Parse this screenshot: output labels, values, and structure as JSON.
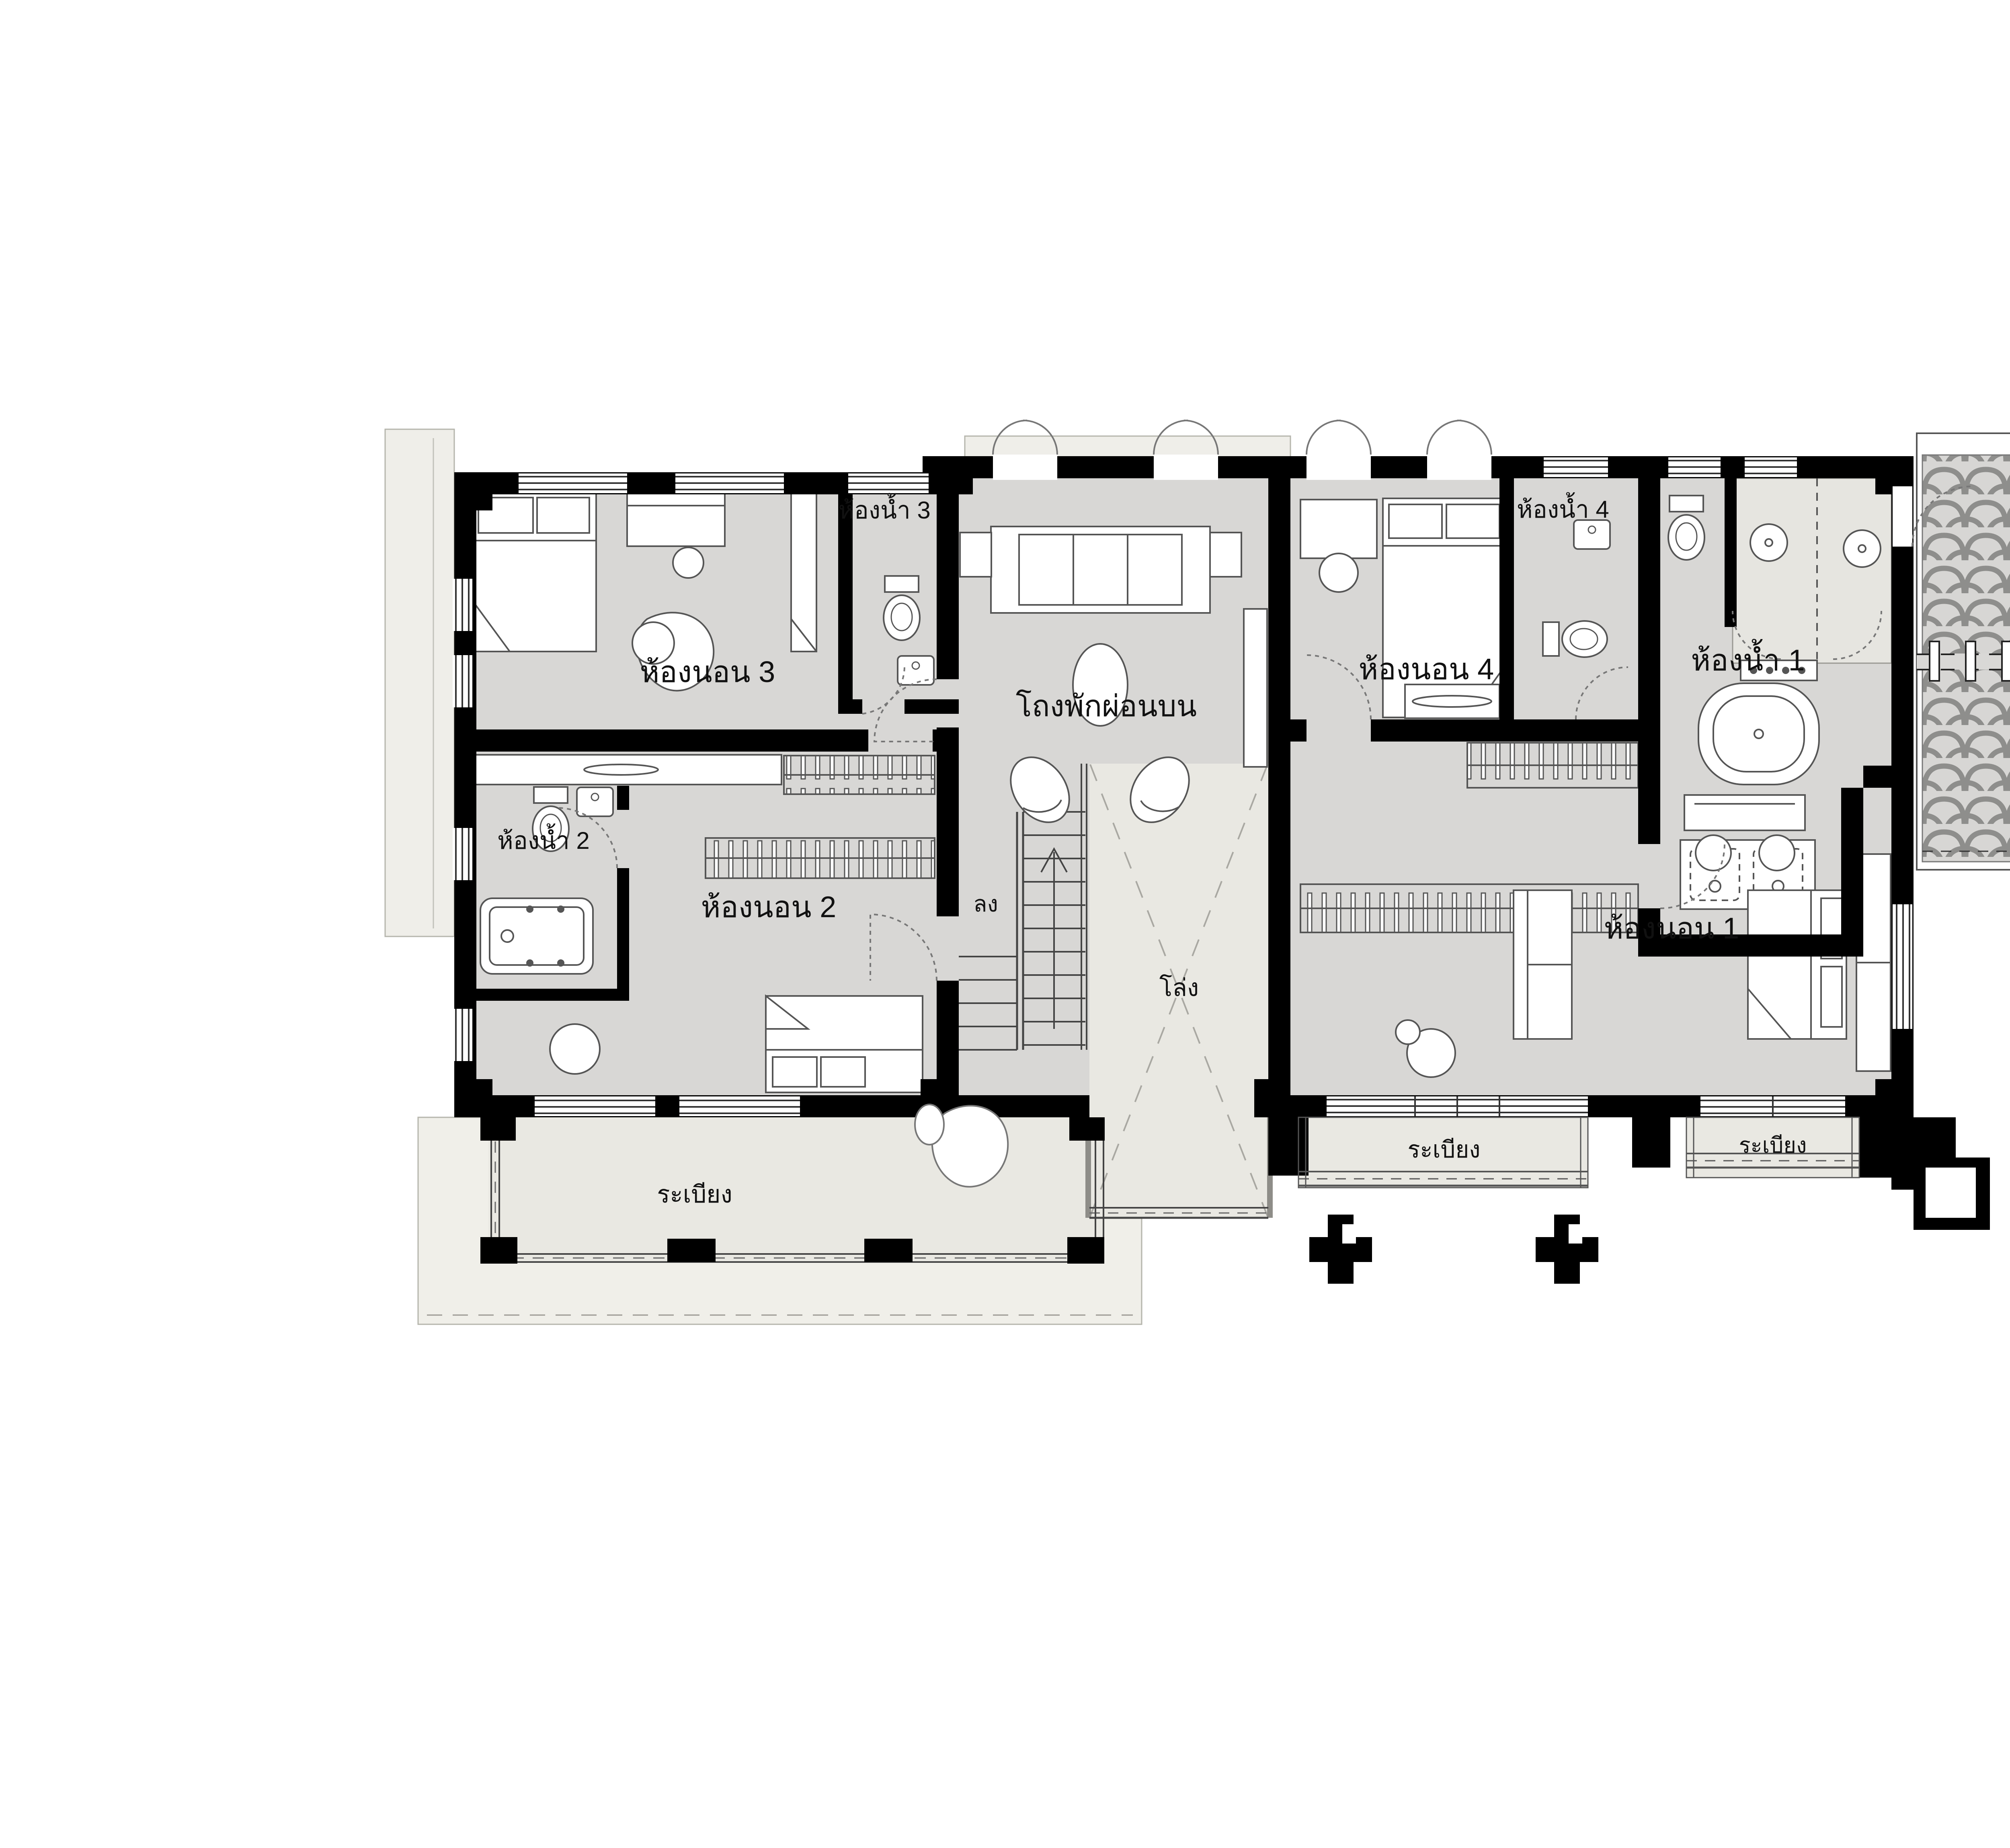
{
  "plan": {
    "code_title": "SH426MCB2/A6 PLAN 2"
  },
  "labels": {
    "bedroom1": "ห้องนอน 1",
    "bedroom2": "ห้องนอน 2",
    "bedroom3": "ห้องนอน 3",
    "bedroom4": "ห้องนอน 4",
    "bathroom1": "ห้องน้ำ 1",
    "bathroom2": "ห้องน้ำ 2",
    "bathroom3": "ห้องน้ำ 3",
    "bathroom4": "ห้องน้ำ 4",
    "upper_hall": "โถงพักผ่อนบน",
    "void": "โล่ง",
    "stair_down": "ลง",
    "balcony_main": "ระเบียง",
    "balcony_bedroom1_left": "ระเบียง",
    "balcony_bedroom1_right": "ระเบียง"
  },
  "colors": {
    "wall": "#000000",
    "room_fill": "#d8d7d5",
    "outdoor_fill": "#e9e8e2",
    "eave_fill": "#efeee9",
    "shower_fill": "#e6e5e0",
    "roof_field": "#d7d6d4",
    "roof_tile_line": "#8e8e8c",
    "detail_line": "#555555",
    "text": "#111111"
  }
}
